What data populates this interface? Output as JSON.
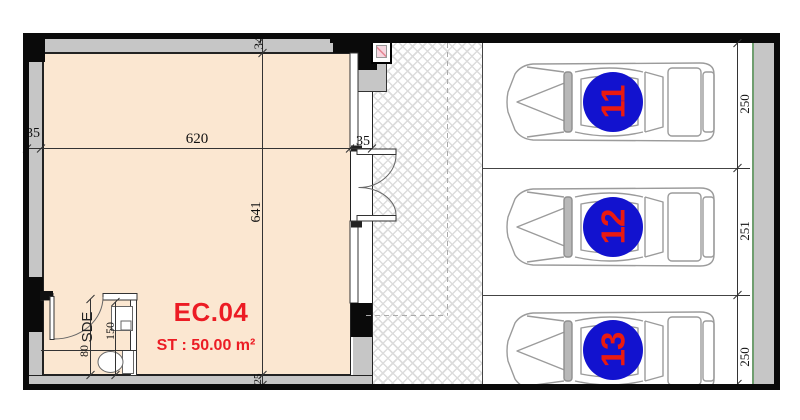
{
  "floor_plan": {
    "unit": {
      "code": "EC.04",
      "area": "ST : 50.00 m²"
    },
    "rooms": {
      "bathroom_label": "SDE"
    },
    "dimensions": {
      "wall_top": "34",
      "wall_left": "35",
      "wall_right": "35",
      "room_width": "620",
      "room_height": "641",
      "bottom_offset": "25",
      "bath_door_width": "80",
      "bath_width": "150"
    }
  },
  "parking": {
    "stalls": [
      {
        "number": "11",
        "depth": "250"
      },
      {
        "number": "12",
        "depth": "251"
      },
      {
        "number": "13",
        "depth": "250"
      }
    ]
  },
  "colors": {
    "accent_red": "#ec1c24",
    "stall_blue": "#1212cf",
    "room_fill": "#fbe7d1",
    "wall_gray": "#c6c6c6",
    "divider_green": "#6f9e6f"
  }
}
